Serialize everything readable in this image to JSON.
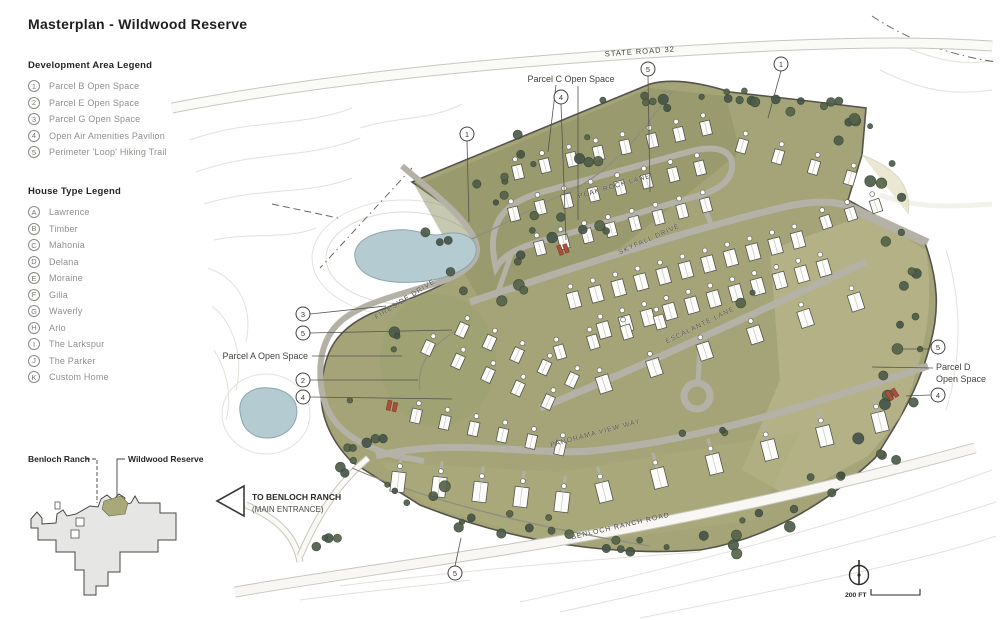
{
  "title": "Masterplan - Wildwood Reserve",
  "dev_legend": {
    "heading": "Development Area Legend",
    "items": [
      {
        "id": "1",
        "label": "Parcel B Open Space"
      },
      {
        "id": "2",
        "label": "Parcel E Open Space"
      },
      {
        "id": "3",
        "label": "Parcel G Open Space"
      },
      {
        "id": "4",
        "label": "Open Air Amenities Pavilion"
      },
      {
        "id": "5",
        "label": "Perimeter 'Loop' Hiking Trail"
      }
    ]
  },
  "house_legend": {
    "heading": "House Type Legend",
    "items": [
      {
        "id": "A",
        "label": "Lawrence"
      },
      {
        "id": "B",
        "label": "Timber"
      },
      {
        "id": "C",
        "label": "Mahonia"
      },
      {
        "id": "D",
        "label": "Delana"
      },
      {
        "id": "E",
        "label": "Moraine"
      },
      {
        "id": "F",
        "label": "Gilia"
      },
      {
        "id": "G",
        "label": "Waverly"
      },
      {
        "id": "H",
        "label": "Arlo"
      },
      {
        "id": "I",
        "label": "The Larkspur"
      },
      {
        "id": "J",
        "label": "The Parker"
      },
      {
        "id": "K",
        "label": "Custom Home"
      }
    ]
  },
  "inset": {
    "left_label": "Benloch Ranch",
    "right_label": "Wildwood Reserve"
  },
  "map": {
    "roads": {
      "state_road": "STATE ROAD 32",
      "peak_rock": "PEAK ROCK LANE",
      "skyfall": "SKYFALL DRIVE",
      "escalante": "ESCALANTE LANE",
      "fireside": "FIRESIDE DRIVE",
      "panorama": "PANORAMA VIEW WAY",
      "benloch": "BENLOCH RANCH ROAD"
    },
    "parcels": {
      "c": "Parcel C Open Space",
      "a": "Parcel A Open Space",
      "d_line1": "Parcel D",
      "d_line2": "Open Space"
    },
    "entrance": {
      "line1": "TO BENLOCH RANCH",
      "line2": "(MAIN ENTRANCE)"
    },
    "scale_label": "200 FT",
    "markers": [
      "1",
      "4",
      "5",
      "1",
      "3",
      "5",
      "2",
      "4",
      "5",
      "4",
      "5"
    ]
  },
  "colors": {
    "site_olive": "#a4a478",
    "site_dark": "#8e9166",
    "site_light": "#bcb88c",
    "tree_green": "#4d5c4a",
    "pond_blue": "#b3cbd1",
    "road_gray": "#b4b2a7",
    "pavilion_red": "#a94f3d",
    "ink": "#3c3a36"
  }
}
